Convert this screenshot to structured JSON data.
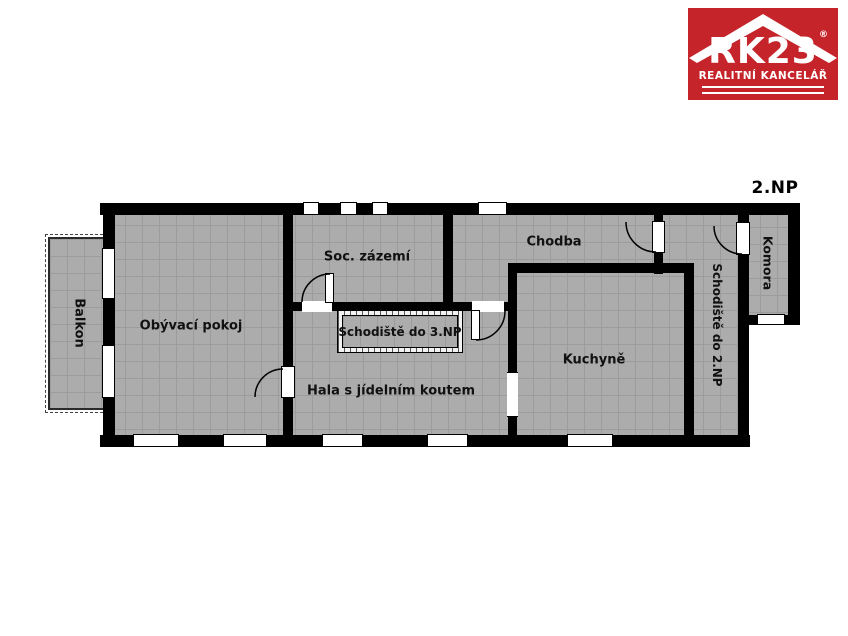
{
  "floor_label": "2.NP",
  "logo": {
    "brand": "RK23",
    "registered": "®",
    "tagline": "REALITNÍ KANCELÁŘ",
    "bg_color": "#c5242a"
  },
  "rooms": {
    "obyvaci_pokoj": "Obývací pokoj",
    "soc_zazemi": "Soc. zázemí",
    "chodba": "Chodba",
    "schodiste_3np": "Schodiště do 3.NP",
    "hala": "Hala s jídelním koutem",
    "kuchyne": "Kuchyně",
    "schodiste_2np": "Schodiště do 2.NP",
    "komora": "Komora",
    "balkon": "Balkon"
  },
  "colors": {
    "wall": "#000000",
    "floor_fill": "#acacac",
    "grid_line": "#9c9c9c",
    "background": "#ffffff",
    "logo_red": "#c5242a"
  }
}
